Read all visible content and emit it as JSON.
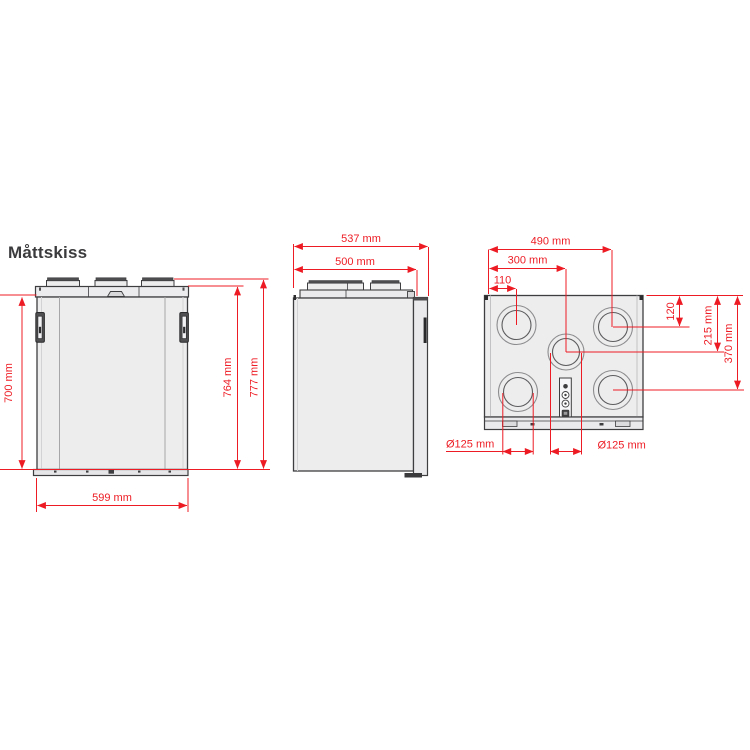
{
  "title": "Måttskiss",
  "colors": {
    "dimension_red": "#ed1c24",
    "drawing_outline": "#3e3e40",
    "panel_fill": "#ededee",
    "background": "#ffffff"
  },
  "front_view": {
    "dimensions": {
      "body_height": "700 mm",
      "height_excl_ducts": "764 mm",
      "total_height": "777 mm",
      "width": "599 mm"
    }
  },
  "side_view": {
    "dimensions": {
      "total_depth": "537 mm",
      "body_depth": "500 mm"
    }
  },
  "top_view": {
    "dimensions": {
      "duct_right_center_x": "490 mm",
      "duct_middle_center_x": "300 mm",
      "duct_left_center_x": "110",
      "duct_top_center_y": "120",
      "duct_middle_center_y": "215 mm",
      "duct_bottom_center_y": "370 mm",
      "duct_diameter_left": "Ø125 mm",
      "duct_diameter_right": "Ø125 mm"
    }
  }
}
